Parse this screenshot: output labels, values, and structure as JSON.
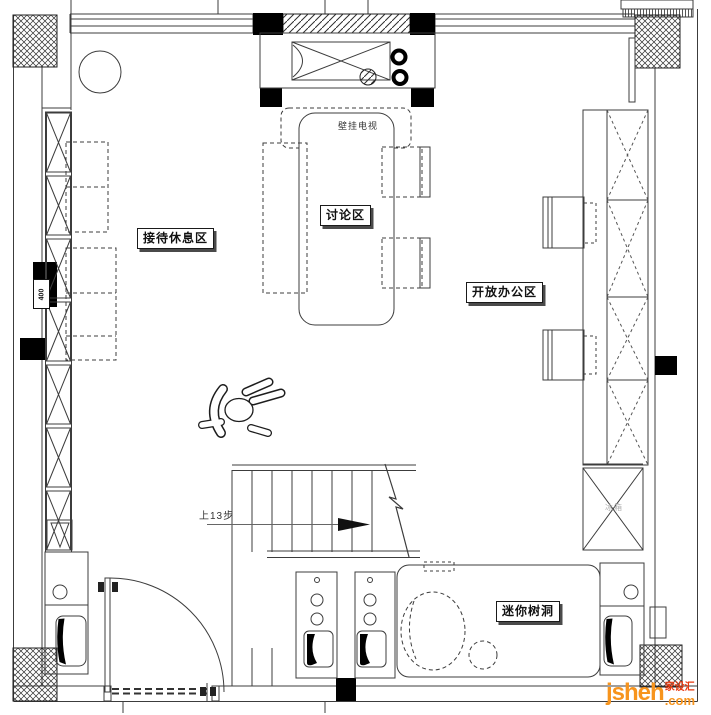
{
  "plan": {
    "areas": {
      "reception": "接待休息区",
      "discussion": "讨论区",
      "open_office": "开放办公区",
      "tree_hole": "迷你树洞"
    },
    "annotations": {
      "wall_tv": "壁挂电视",
      "stairs_direction": "上13步",
      "dimension": "400",
      "appliance": "冰箱"
    }
  },
  "watermark": {
    "brand": "jsheh",
    "domain_suffix": ".com",
    "site_name_cn": "家设汇",
    "orange": "#F7941D",
    "red": "#E8380D"
  }
}
